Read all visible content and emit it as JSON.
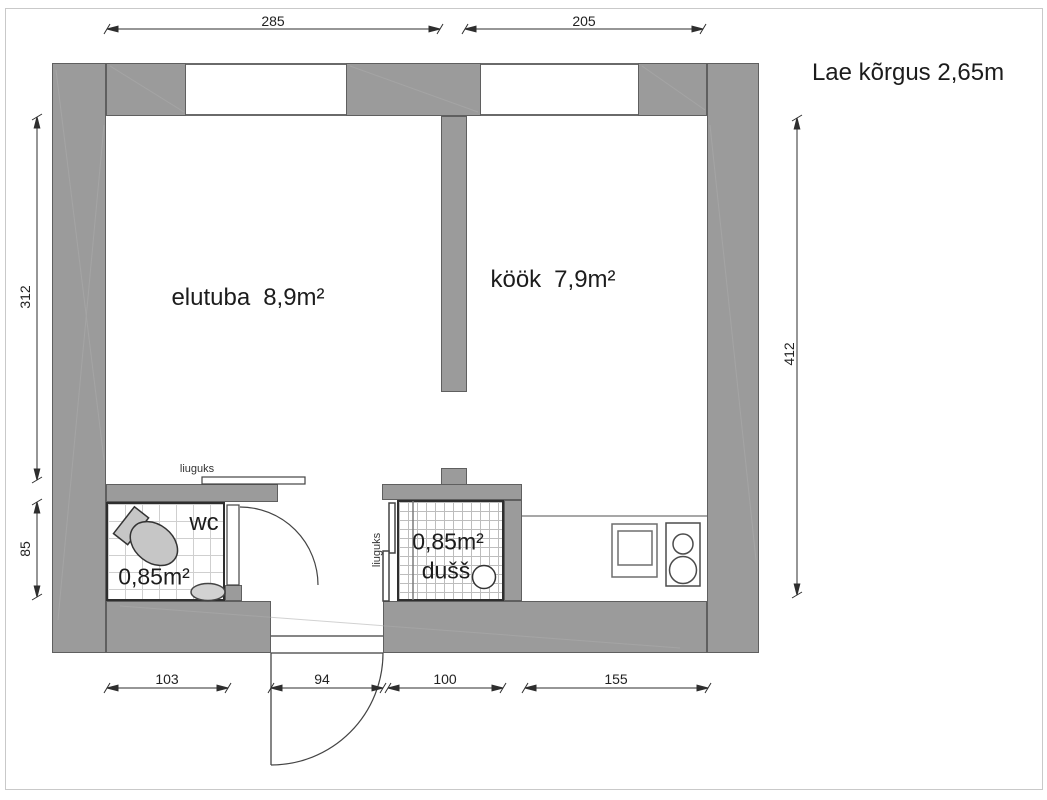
{
  "plan": {
    "ceiling_note": "Lae kõrgus 2,65m",
    "rooms": {
      "living": {
        "name": "elutuba",
        "area": "8,9m²"
      },
      "kitchen": {
        "name": "köök",
        "area": "7,9m²"
      },
      "wc": {
        "name": "wc",
        "area": "0,85m²"
      },
      "shower": {
        "name": "dušš",
        "area": "0,85m²"
      }
    },
    "labels": {
      "wc_sliding_door": "liuguks",
      "shower_sliding_door": "liuguks"
    },
    "dimensions_cm": {
      "living_width": "285",
      "kitchen_width": "205",
      "living_height": "312",
      "wc_height": "85",
      "total_height": "412",
      "wc_width": "103",
      "entry_width": "94",
      "shower_width": "100",
      "kitchen_counter_width": "155"
    },
    "colors": {
      "wall": "#9b9b9b",
      "wall_outline": "#5f5f5f",
      "line": "#3c3c3c",
      "fixture": "#c6c6c6",
      "text": "#1c1c1c"
    }
  }
}
